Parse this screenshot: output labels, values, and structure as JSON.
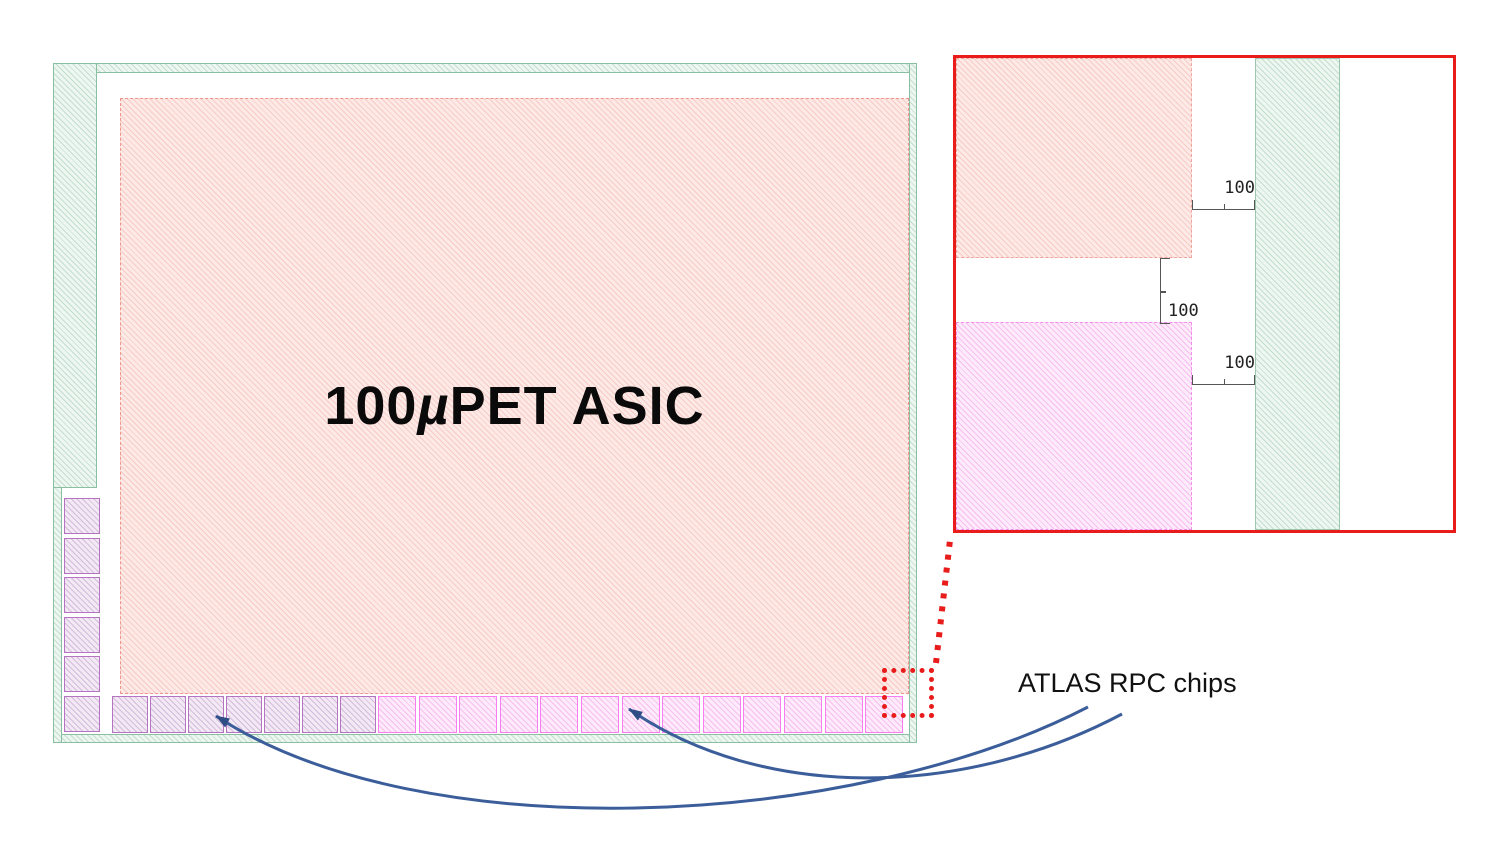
{
  "chip_view": {
    "asic_label": {
      "pre": "100",
      "mu": "µ",
      "post": "PET ASIC"
    },
    "left_pad_count": 6,
    "bottom_pad_muted_count": 7,
    "bottom_pad_bright_count": 13
  },
  "inset": {
    "dim_top": "100",
    "dim_mid": "100",
    "dim_bottom": "100"
  },
  "annotation_label": "ATLAS RPC chips",
  "colors": {
    "asic_hatch_pink": "#f7cbc6",
    "seal_ring_green": "#c2decd",
    "pad_bright_magenta": "#f77df0",
    "pad_muted_purple": "#b474c2",
    "highlight_red": "#e91c1c",
    "arrow_blue": "#3b5e9b"
  }
}
